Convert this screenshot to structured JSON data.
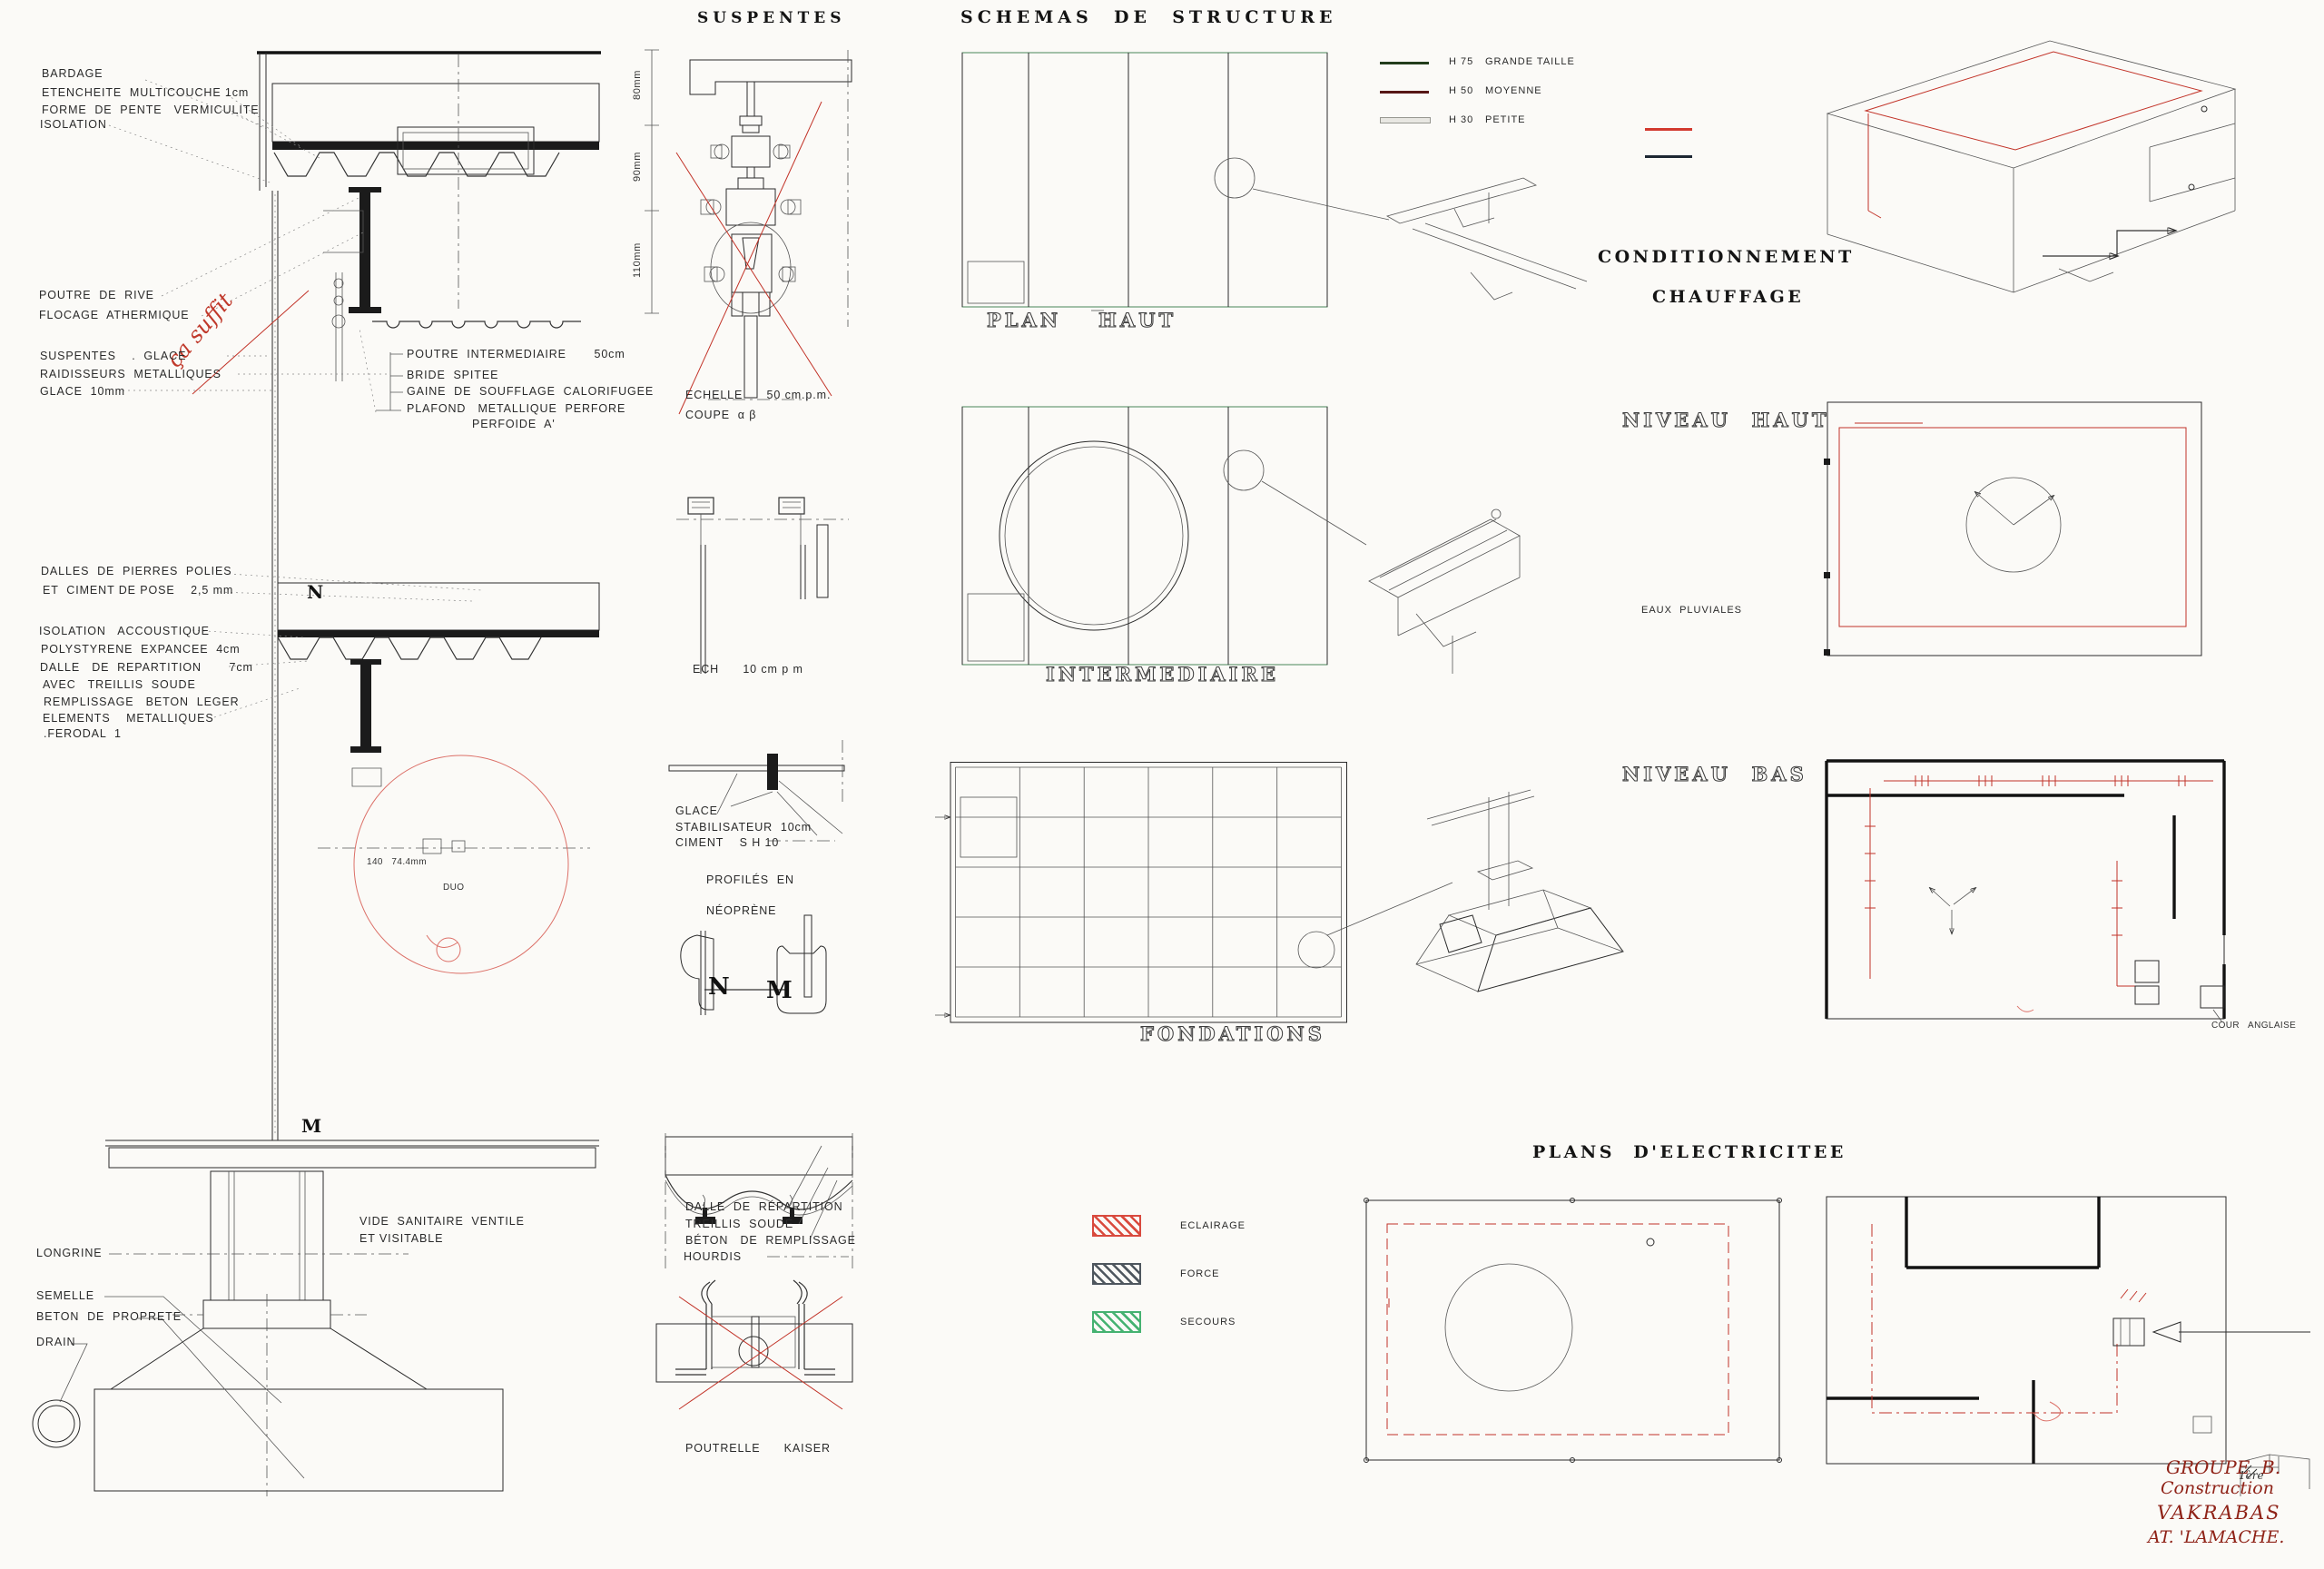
{
  "section": {
    "bardage": "BARDAGE",
    "etancheite": "ETENCHEITE  MULTICOUCHE 1cm",
    "forme_pente": "FORME  DE  PENTE   VERMICULITE",
    "isolation": "ISOLATION",
    "poutre_de_rive": "POUTRE  DE  RIVE",
    "flocage": "FLOCAGE  ATHERMIQUE",
    "note_rouge": "ça suffit",
    "suspentes_glace": "SUSPENTES    .  GLACE",
    "raidisseurs": "RAIDISSEURS  METALLIQUES",
    "glace_10": "GLACE  10mm",
    "poutre_intermediaire": "POUTRE  INTERMEDIAIRE       50cm",
    "bride": "BRIDE  SPITEE",
    "gaine": "GAINE  DE  SOUFFLAGE  CALORIFUGEE",
    "plafond": "PLAFOND   METALLIQUE  PERFORE",
    "perfoide": "PERFOIDE  A'",
    "marker_n": "N",
    "dalles": "DALLES  DE  PIERRES  POLIES",
    "ciment_pose": "ET  CIMENT DE POSE    2,5 mm",
    "isolation_acoustique": "ISOLATION   ACCOUSTIQUE",
    "polystyrene": "POLYSTYRENE  EXPANCEE  4cm",
    "dalle_repartition": "DALLE   DE  REPARTITION       7cm",
    "avec_treillis": "AVEC   TREILLIS  SOUDE",
    "remplissage": "REMPLISSAGE   BETON  LEGER",
    "elements": "ELEMENTS    METALLIQUES",
    "ferodal": ".FERODAL  1",
    "dim_140": "140   74.4mm",
    "duo": "DUO",
    "marker_m": "M",
    "vide_sanitaire": "VIDE  SANITAIRE  VENTILE",
    "et_visitable": "ET VISITABLE",
    "longrine": "LONGRINE",
    "semelle": "SEMELLE",
    "beton_proprete": "BETON  DE  PROPRETE",
    "drain": "DRAIN"
  },
  "suspentes": {
    "title": "SUSPENTES",
    "dim_80": "80mm",
    "dim_90": "90mm",
    "dim_110": "110mm",
    "echelle": "ECHELLE      50 cm.p.m.",
    "coupe": "COUPE  α β",
    "ech_10": "ECH      10 cm p m",
    "glace": "GLACE",
    "stabilisateur": "STABILISATEUR  10cm",
    "ciment": "CIMENT    S H 10",
    "profiles_en": "PROFILÉS  EN",
    "neoprene": "NÉOPRÈNE",
    "marker_n": "N",
    "marker_m": "M",
    "dalle_repartition": "DALLE  DE  RÉPARTITION",
    "treillis": "TREILLIS  SOUDÉ",
    "beton_remplissage": "BÉTON   DE  REMPLISSAGE",
    "hourdis": "HOURDIS",
    "poutrelle": "POUTRELLE      KAISER"
  },
  "structure": {
    "title": "SCHEMAS  DE  STRUCTURE",
    "plan": "PLAN",
    "haut": "HAUT",
    "intermediaire": "INTERMEDIAIRE",
    "fondations": "FONDATIONS",
    "legend": [
      {
        "code": "H 75",
        "label": "GRANDE TAILLE",
        "color": "#233d1c"
      },
      {
        "code": "H 50",
        "label": "MOYENNE",
        "color": "#571716"
      },
      {
        "code": "H 30",
        "label": "PETITE",
        "color": "#e8e7e2"
      }
    ]
  },
  "conditionnement": {
    "line1": "CONDITIONNEMENT",
    "line2": "CHAUFFAGE",
    "legend_red": "#d2392e",
    "legend_black": "#1d2733",
    "niveau_haut": "NIVEAU  HAUT",
    "eaux_pluviales": "EAUX  PLUVIALES",
    "niveau_bas": "NIVEAU  BAS",
    "cour_anglaise": "COUR   ANGLAISE"
  },
  "electricite": {
    "title": "PLANS  D'ELECTRICITEE",
    "legend": [
      {
        "label": "ECLAIRAGE",
        "color": "#d94a3e"
      },
      {
        "label": "FORCE",
        "color": "#4e565e"
      },
      {
        "label": "SECOURS",
        "color": "#45b271"
      }
    ]
  },
  "signature": {
    "groupe": "GROUPE  B.",
    "construction": "Construction",
    "ligne3": "VAKRABAS",
    "ligne4": "AT. 'LAMACHE.",
    "note": "1ère"
  }
}
